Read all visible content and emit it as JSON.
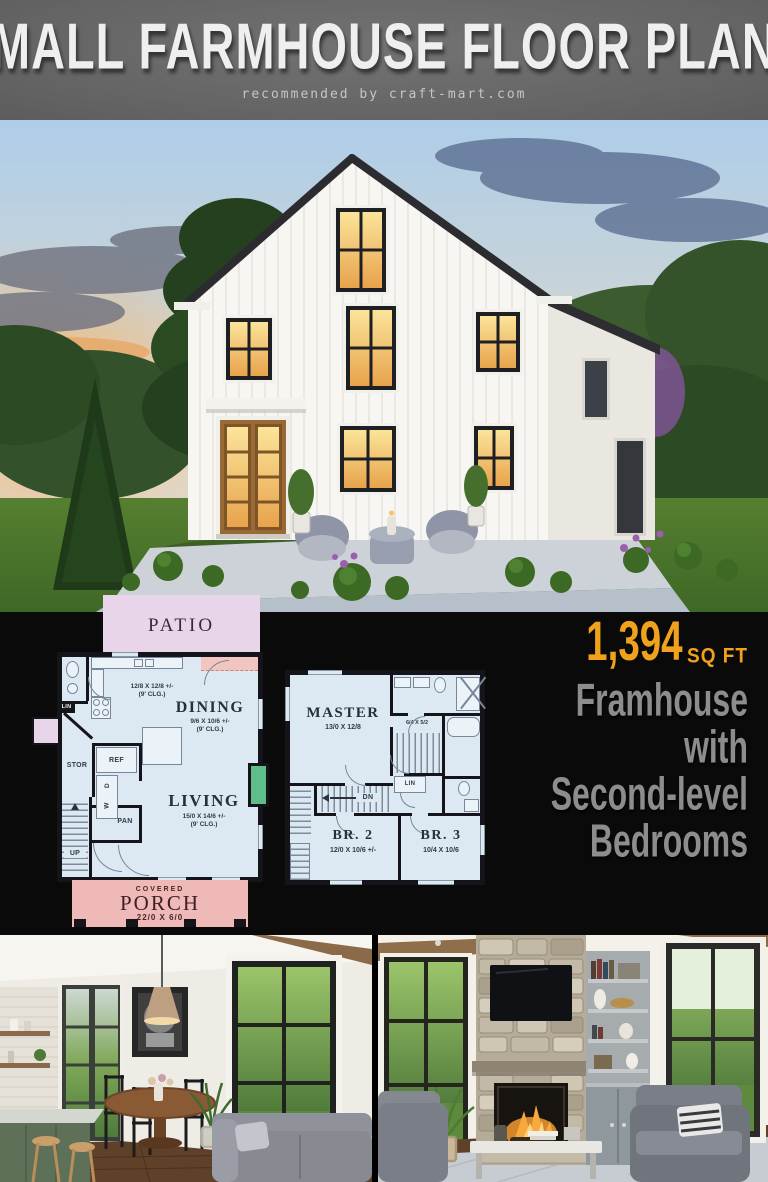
{
  "header": {
    "title": "SMALL FARMHOUSE FLOOR PLANS",
    "subtitle": "recommended by craft-mart.com"
  },
  "plan1": {
    "patio": "PATIO",
    "kitchen_dims": "12/8 X 12/8 +/-",
    "clg": "(9' CLG.)",
    "dining": "DINING",
    "dining_dims": "9/6 X 10/6 +/-",
    "living": "LIVING",
    "living_dims": "15/0 X 14/6 +/-",
    "stor": "STOR",
    "ref": "REF",
    "washer": "W",
    "dryer": "D",
    "pan": "PAN",
    "up": "UP",
    "lin": "LIN",
    "porch_covered": "COVERED",
    "porch": "PORCH",
    "porch_dims": "22/0 X 6/0"
  },
  "plan2": {
    "master": "MASTER",
    "master_dims": "13/0 X 12/8",
    "closet_dims": "6/4 X 5/2",
    "lin": "LIN",
    "dn": "DN",
    "br2": "BR. 2",
    "br2_dims": "12/0 X 10/6 +/-",
    "br3": "BR. 3",
    "br3_dims": "10/4 X 10/6"
  },
  "callout": {
    "sqft_value": "1,394",
    "sqft_unit": "SQ FT",
    "line1": "Framhouse",
    "line2": "with",
    "line3": "Second-level",
    "line4": "Bedrooms"
  },
  "colors": {
    "accent_orange": "#f1a21c",
    "callout_gray": "#8d8d8d",
    "plan_fill": "#dce9f2",
    "wall": "#14141a",
    "patio_fill": "#e8d5e9",
    "porch_fill": "#eeb9b7",
    "fireplace_green": "#5fbd8b",
    "header_bg": "#686868",
    "section_bg": "#0a0a0a"
  }
}
